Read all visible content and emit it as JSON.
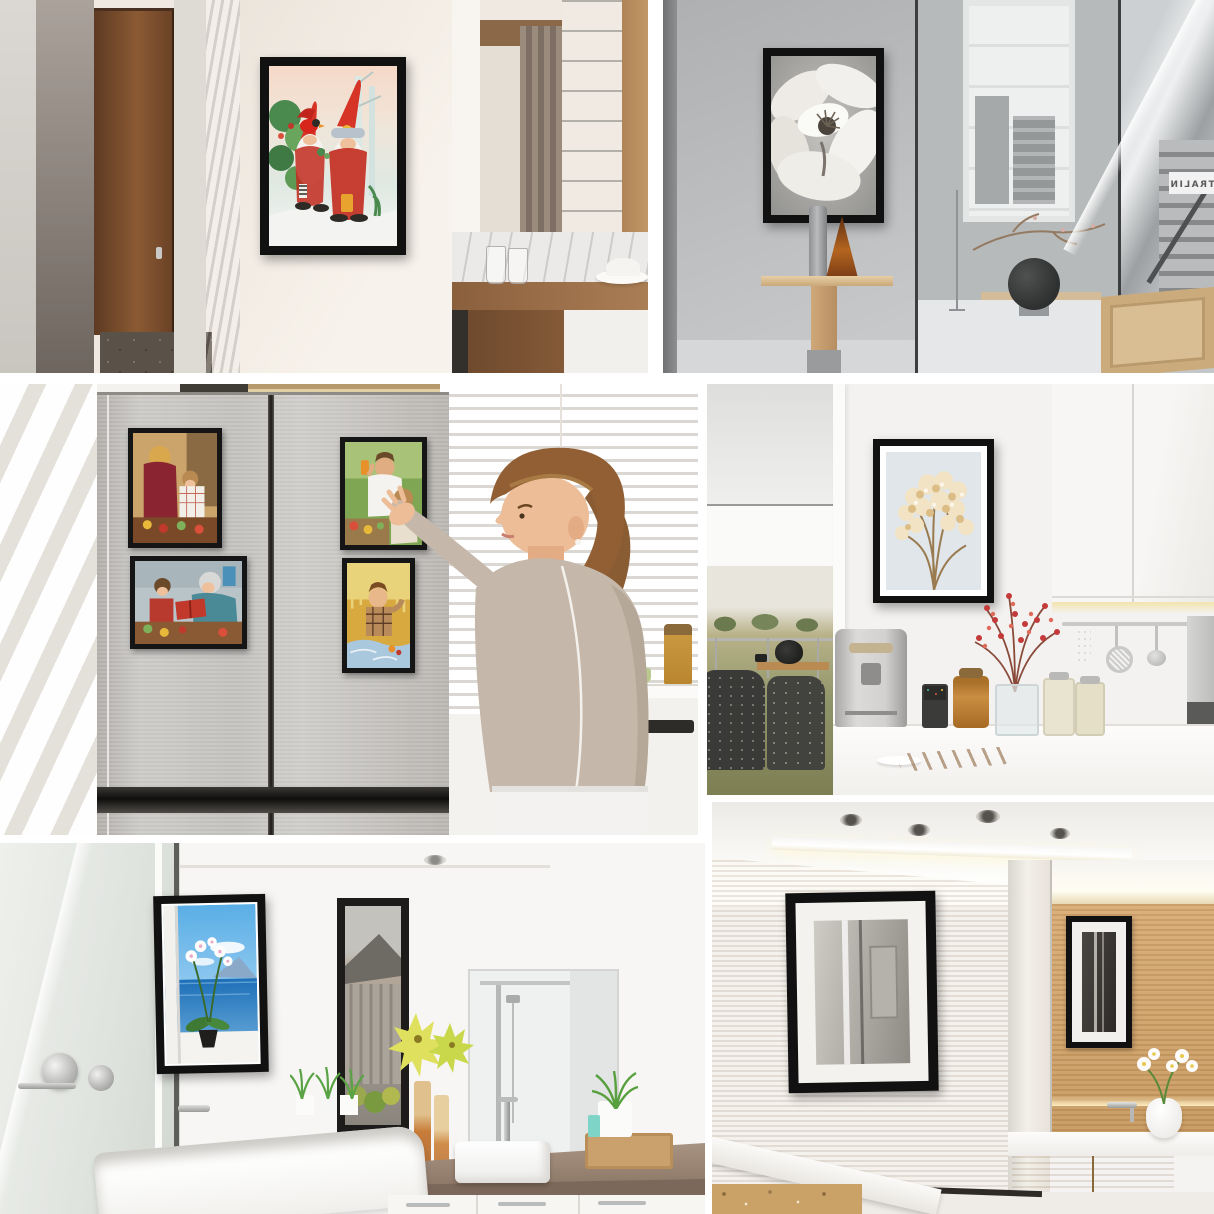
{
  "collage": {
    "title": "Black magnetic picture frames shown in six interior settings",
    "background": "#ffffff",
    "sign": {
      "text": "CENTRALIN",
      "mirrored": true
    },
    "panels": [
      {
        "id": "hotel-hallway",
        "description": "Hotel hallway with brown wooden door, cream wall with black framed Christmas gnome artwork, mirror, taupe curtain and wooden desk with glasses and a white hat",
        "art_subject": "Two red-hat gnomes with a red cardinal bird in a snowy holly scene"
      },
      {
        "id": "gray-gallery",
        "description": "Minimalist gray gallery interior with black framed magnolia photograph above a plywood side table with two vessels, atrium window with city view, round black speaker and steel staircase",
        "art_subject": "Black and white magnolia flower close-up"
      },
      {
        "id": "fridge-kitchen",
        "description": "Woman in a beige sweater arranging four black magnetic photo frames on a stainless steel double-door refrigerator in front of white window blinds",
        "fridge_photos": [
          "Mother and daughter cooking together",
          "Grandmother reading a red book with a little girl among vegetables",
          "Family picnic with man raising an orange drink",
          "Boy in a plaid shirt sitting on a blue blanket in a wheat field"
        ]
      },
      {
        "id": "white-kitchen",
        "description": "White kitchen wall with black framed dried flowers print, espresso machine, storage jars, vase of red berry branches, baguette and hanging utensils under white cabinets",
        "art_subject": "Dried cream flowers on pale blue background"
      },
      {
        "id": "bathroom-tub",
        "description": "White bathroom with black framed ocean and orchid print beside a window, glass shower panel, bathtub, stone vanity counter with vessel sink and mirror",
        "art_subject": "Potted white orchid in front of blue sea and sky"
      },
      {
        "id": "wood-bathroom",
        "description": "Wood panelled bathroom with black framed white-matted picture, large wall mirror reflecting a matching frame, floating wood vanity with white counter and orchid vase"
      }
    ],
    "palette": {
      "frame": "#111111",
      "mat": "#ffffff",
      "fridge_steel": "#c8c6c2",
      "wood_wall": "#d2a472",
      "gallery_gray": "#bcbec0",
      "cream_wall": "#efe9e1",
      "sweater_beige": "#c5b8aa",
      "gnome_red": "#d63426",
      "sea_blue": "#2a74b8"
    }
  }
}
